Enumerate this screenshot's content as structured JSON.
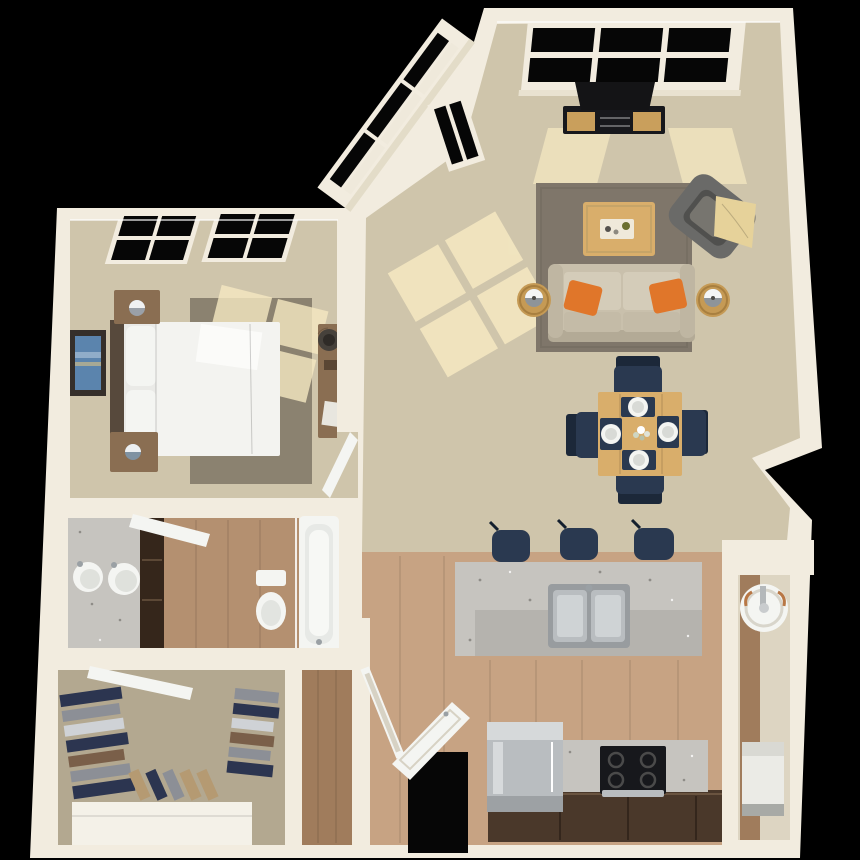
{
  "scene": {
    "type": "3d-floor-plan-render",
    "view": "top-down-isometric",
    "background": "black",
    "unit": "one-bedroom apartment"
  },
  "palette": {
    "bg": "#000000",
    "wall": "#f2ecdf",
    "wall_shadow": "#ddd5c2",
    "carpet": "#cfc5ab",
    "carpet_dark": "#b3a890",
    "sun": "#f6e9c2",
    "wood": "#c7a383",
    "wood_dark": "#a07c5c",
    "wood_bath": "#b49070",
    "granite": "#c6c4bf",
    "granite_dark": "#a8a6a1",
    "rug_living": "#7f766a",
    "rug_bedroom": "#8b8270",
    "bed_white": "#eaeae7",
    "headboard": "#57493c",
    "nightstand": "#8a6e52",
    "sofa": "#c9c0ac",
    "sofa_dark": "#b3aa96",
    "sofa_cushion": "#d4ccb9",
    "pillow_orange": "#e0762a",
    "armchair": "#6a6a68",
    "armchair_dark": "#50504e",
    "throw": "#e6d29a",
    "table_wood": "#d9ae6b",
    "chair_navy": "#2a3950",
    "chair_navy_dark": "#1c2839",
    "tv_black": "#17181c",
    "console_wood": "#c99f5c",
    "steel": "#b9bdc0",
    "steel_dark": "#989c9f",
    "cabinet_brown": "#4a382a",
    "glass_black": "#060606",
    "porcelain": "#f4f5f2",
    "copper": "#b87745",
    "art_blue": "#5b84ad",
    "frame_dark": "#352f2a",
    "clothes_navy": "#2c3550",
    "clothes_gray": "#8c8f96",
    "clothes_brown": "#7a5f49",
    "clothes_light": "#cfd2d6",
    "shoe_tan": "#b59a72"
  },
  "rooms": [
    {
      "name": "Bedroom",
      "floor": "carpet",
      "items": [
        "queen bed",
        "headboard",
        "2 pillows",
        "2 nightstands",
        "2 table lamps",
        "area rug",
        "wall art",
        "desk",
        "desk chair",
        "2 black-pane windows",
        "open door",
        "sunlight patches"
      ]
    },
    {
      "name": "Living Room",
      "floor": "carpet",
      "items": [
        "sofa",
        "2 orange throw pillows",
        "2 round side tables",
        "2 drum lamps",
        "area rug",
        "coffee table with tray",
        "gray armchair",
        "cream throw blanket",
        "flat tv",
        "media console",
        "triple picture window",
        "angled bay windows",
        "sunlight patches"
      ]
    },
    {
      "name": "Dining Area",
      "floor": "carpet",
      "items": [
        "square wood table",
        "4 navy chairs",
        "4 place settings",
        "flower centerpiece"
      ]
    },
    {
      "name": "Kitchen",
      "floor": "hardwood",
      "items": [
        "granite breakfast island",
        "double stainless sink",
        "3 navy bar stools",
        "stainless refrigerator",
        "black range with 4 burners",
        "granite counter",
        "dark base cabinets",
        "open entry door"
      ]
    },
    {
      "name": "Bathroom",
      "floor": "hardwood",
      "items": [
        "granite double vanity",
        "2 round sinks",
        "dark linen cabinet",
        "toilet",
        "bathtub",
        "glass divider",
        "open door"
      ]
    },
    {
      "name": "Walk-in Closet",
      "floor": "carpet",
      "items": [
        "hanging clothes left rail",
        "hanging clothes right rail",
        "row of shoes",
        "white dresser",
        "open door"
      ]
    },
    {
      "name": "Hallway",
      "floor": "hardwood",
      "items": [
        "open glass door"
      ]
    },
    {
      "name": "Utility Closet",
      "floor": "hardwood",
      "items": [
        "water heater with copper pipes",
        "white appliance"
      ]
    }
  ]
}
